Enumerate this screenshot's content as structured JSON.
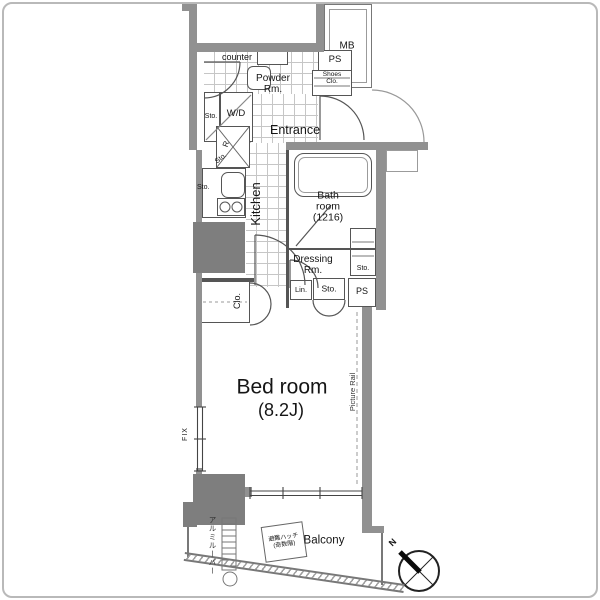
{
  "floor_plan": {
    "rooms": {
      "bedroom": {
        "label": "Bed room",
        "size": "(8.2J)"
      },
      "kitchen": {
        "label": "Kitchen"
      },
      "entrance": {
        "label": "Entrance"
      },
      "bathroom": {
        "line1": "Bath",
        "line2": "room",
        "line3": "(1216)"
      },
      "dressing_room": {
        "line1": "Dressing",
        "line2": "Rm."
      },
      "powder_room": {
        "line1": "Powder",
        "line2": "Rm."
      },
      "balcony": {
        "label": "Balcony"
      }
    },
    "fixtures": {
      "counter": "counter",
      "meter_box": "MB",
      "pipe_space": "PS",
      "shoes_closet_line1": "Shoes",
      "shoes_closet_line2": "Clo.",
      "washer_dryer": "W/D",
      "refrigerator": "R",
      "storage": "Sto.",
      "closet": "Clo.",
      "linen": "Lin."
    },
    "annotations": {
      "fix_window": "FIX",
      "picture_rail": "Picture Rail",
      "evacuation_hatch_line1": "避難ハッチ",
      "evacuation_hatch_line2": "(奇数階)",
      "aluminum_louver": "アルミルーバー",
      "compass_north": "N"
    },
    "colors": {
      "wall": "#919191",
      "pillar": "#7e7e7e",
      "line": "#555555",
      "tile_line": "#c6c6c6",
      "text": "#151515"
    }
  }
}
